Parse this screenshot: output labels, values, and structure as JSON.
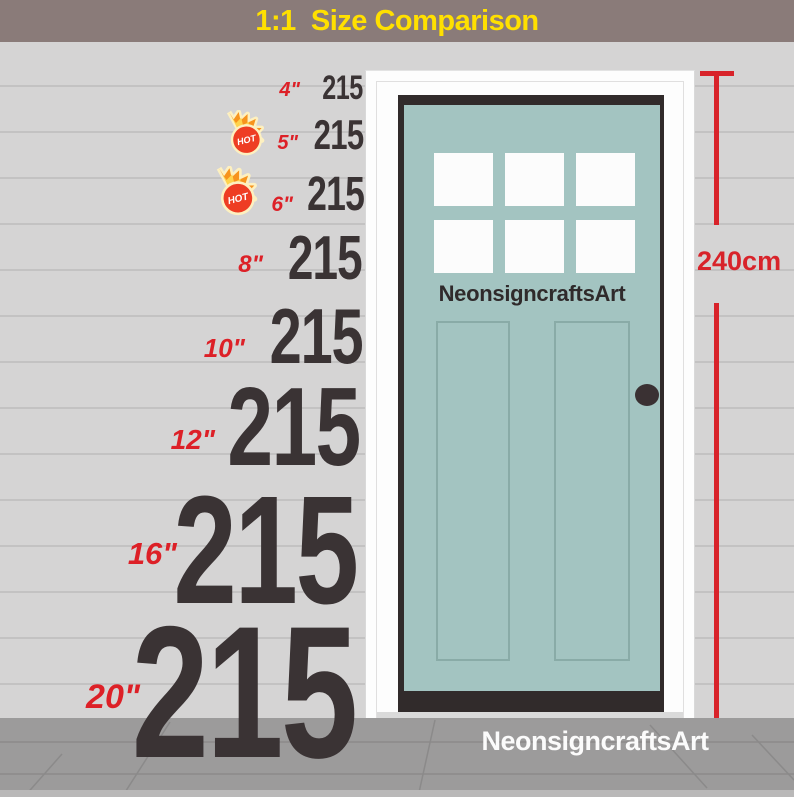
{
  "banner": {
    "title": "1:1  Size Comparison"
  },
  "comparison": {
    "hot_badge_text": "HOT",
    "rows": [
      {
        "size": "4\"",
        "value": "215",
        "hot": false
      },
      {
        "size": "5\"",
        "value": "215",
        "hot": true
      },
      {
        "size": "6\"",
        "value": "215",
        "hot": true
      },
      {
        "size": "8\"",
        "value": "215",
        "hot": false
      },
      {
        "size": "10\"",
        "value": "215",
        "hot": false
      },
      {
        "size": "12\"",
        "value": "215",
        "hot": false
      },
      {
        "size": "16\"",
        "value": "215",
        "hot": false
      },
      {
        "size": "20\"",
        "value": "215",
        "hot": false
      }
    ]
  },
  "door": {
    "brand": "NeonsigncraftsArt",
    "height_label": "240cm",
    "window_panes": 6
  },
  "floor": {
    "brand": "NeonsigncraftsArt"
  },
  "colors": {
    "banner_bg": "#8a7b79",
    "banner_text": "#ffe000",
    "accent_red": "#d8232a",
    "number_charcoal": "#3a3334",
    "door_teal": "#a3c4c1",
    "wall_gray": "#d5d4d4",
    "floor_gray": "#9c9b9b"
  }
}
